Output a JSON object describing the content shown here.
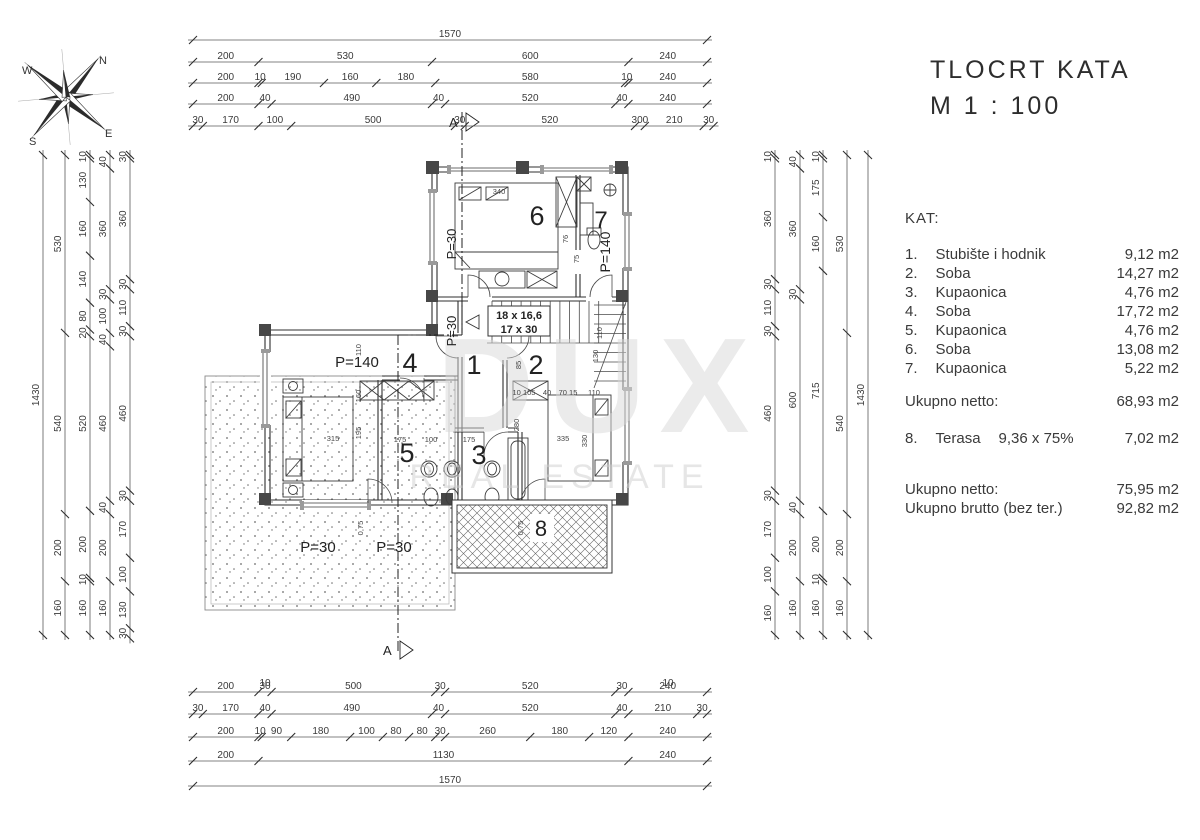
{
  "title": {
    "line1": "TLOCRT KATA",
    "line2": "M 1 : 100"
  },
  "legend": {
    "heading": "KAT:",
    "rooms": [
      {
        "num": "1.",
        "name": "Stubište i hodnik",
        "area": "9,12 m2"
      },
      {
        "num": "2.",
        "name": "Soba",
        "area": "14,27 m2"
      },
      {
        "num": "3.",
        "name": "Kupaonica",
        "area": "4,76 m2"
      },
      {
        "num": "4.",
        "name": "Soba",
        "area": "17,72 m2"
      },
      {
        "num": "5.",
        "name": "Kupaonica",
        "area": "4,76 m2"
      },
      {
        "num": "6.",
        "name": "Soba",
        "area": "13,08 m2"
      },
      {
        "num": "7.",
        "name": "Kupaonica",
        "area": "5,22 m2"
      }
    ],
    "subtotal_label": "Ukupno netto:",
    "subtotal_value": "68,93 m2",
    "terrace_num": "8.",
    "terrace_name": "Terasa",
    "terrace_calc": "9,36 x 75%",
    "terrace_value": "7,02 m2",
    "total_netto_label": "Ukupno netto:",
    "total_netto_value": "75,95 m2",
    "total_brutto_label": "Ukupno brutto (bez ter.)",
    "total_brutto_value": "92,82 m2"
  },
  "compass": {
    "n": "N",
    "s": "S",
    "e": "E",
    "w": "W"
  },
  "section_marker": "A",
  "watermark": {
    "big": "DUX",
    "sub": "REAL ESTATE"
  },
  "dims": {
    "top": [
      [
        "1570"
      ],
      [
        "200",
        "530",
        "600",
        "240"
      ],
      [
        "200",
        "10",
        "190",
        "160",
        "180",
        "580",
        "10",
        "240"
      ],
      [
        "200",
        "40",
        "490",
        "40",
        "520",
        "40",
        "240"
      ],
      [
        "30",
        "170",
        "100",
        "500",
        "30",
        "520",
        "300",
        "210",
        "30"
      ]
    ],
    "bottom": [
      [
        "200",
        "30",
        "500",
        "30",
        "520",
        "30",
        "240"
      ],
      [
        "30",
        "170",
        "40",
        "490",
        "40",
        "520",
        "40",
        "210",
        "30"
      ],
      [
        "200",
        "10",
        "90",
        "180",
        "100",
        "80",
        "80",
        "30",
        "260",
        "180",
        "120",
        "240"
      ],
      [
        "200",
        "1130",
        "240"
      ],
      [
        "1570"
      ]
    ],
    "left": [
      [
        "1430"
      ],
      [
        "530",
        "540",
        "200",
        "160"
      ],
      [
        "10",
        "130",
        "160",
        "140",
        "80",
        "20",
        "520",
        "200",
        "10",
        "160"
      ],
      [
        "40",
        "360",
        "30",
        "100",
        "40",
        "460",
        "40",
        "200",
        "160"
      ],
      [
        "30",
        "360",
        "30",
        "110",
        "30",
        "460",
        "30",
        "170",
        "100",
        "130",
        "30"
      ]
    ],
    "right": [
      [
        "10",
        "360",
        "30",
        "110",
        "30",
        "460",
        "30",
        "170",
        "100",
        "160"
      ],
      [
        "40",
        "360",
        "30",
        "600",
        "40",
        "200",
        "160"
      ],
      [
        "10",
        "175",
        "160",
        "715",
        "200",
        "10",
        "160"
      ],
      [
        "530",
        "540",
        "200",
        "160"
      ],
      [
        "1430"
      ]
    ],
    "micro": [
      "10",
      "10"
    ]
  },
  "plan": {
    "rooms": [
      "6",
      "7",
      "4",
      "1",
      "2",
      "5",
      "3",
      "8"
    ],
    "p_labels": [
      "P=30",
      "P=140",
      "P=140",
      "P=30",
      "P=30",
      "P=30"
    ],
    "stairs": [
      "18 x 16,6",
      "17 x 30"
    ],
    "small_dims": [
      "340",
      "110",
      "160",
      "195",
      "315",
      "175",
      "100",
      "175",
      "280",
      "85",
      "10 105",
      "40",
      "70 15",
      "110",
      "335",
      "330",
      "110",
      "130",
      "75",
      "76",
      "0,75",
      "0,75"
    ]
  }
}
